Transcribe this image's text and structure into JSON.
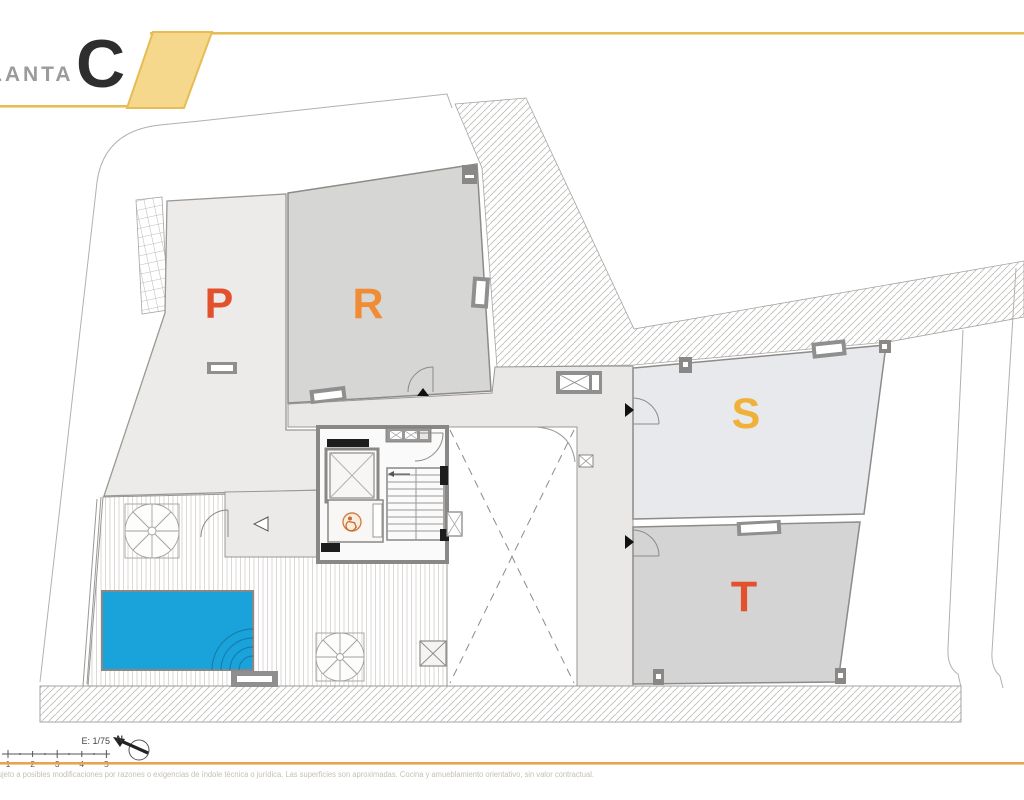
{
  "header": {
    "floor_label": "PLANTA",
    "floor_letter": "C",
    "band_fill": "#f6d88c",
    "band_border": "#e6bd55"
  },
  "plan": {
    "rooms": [
      {
        "id": "P",
        "label": "P",
        "color": "#e2502d"
      },
      {
        "id": "R",
        "label": "R",
        "color": "#ef8c35"
      },
      {
        "id": "S",
        "label": "S",
        "color": "#efb13a"
      },
      {
        "id": "T",
        "label": "T",
        "color": "#e2502d"
      }
    ],
    "colors": {
      "room_p_fill": "#ecebe9",
      "room_r_fill": "#d6d6d5",
      "room_s_fill": "#e8e9ec",
      "room_t_fill": "#d3d4d3",
      "corridor_fill": "#eae8e7",
      "pool": "#1aa2da",
      "pool_step_line": "#1580ad",
      "wall": "#8d8b88"
    }
  },
  "scale_bar": {
    "label": "E: 1/75",
    "ticks": [
      "1",
      "2",
      "3",
      "4",
      "5"
    ]
  },
  "north": {
    "label": "N"
  },
  "footer": {
    "accent_color": "#eba24f",
    "disclaimer": "sujeto a posibles modificaciones por razones o exigencias de índole técnica o jurídica. Las superficies son aproximadas. Cocina y amueblamiento orientativo, sin valor contractual."
  }
}
